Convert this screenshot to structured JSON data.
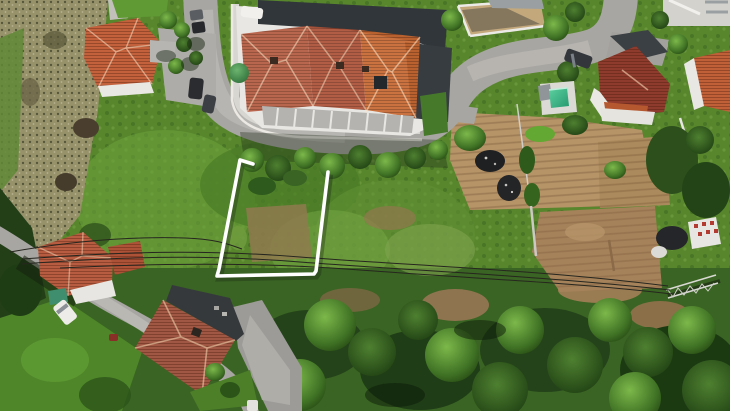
{
  "scene": {
    "type": "aerial-drone-photograph",
    "description": "Aerial drone view of a hillside building plot marked with a white boundary outline, surrounded by houses with terracotta tile roofs, curving asphalt streets, vegetable gardens, scrubland, power lines with a lattice pylon, and dense trees",
    "width_px": 730,
    "height_px": 411
  },
  "palette": {
    "field_green": "#57862d",
    "field_light": "#7db64a",
    "field_dark": "#2f5a1d",
    "forest_dark": "#24431a",
    "forest_base": "#3a6423",
    "scrub_khaki": "#97926a",
    "scrub_dark": "#4a4232",
    "road_gray": "#a8a6a2",
    "road_light": "#c2c0bb",
    "sidewalk": "#d8d6d1",
    "wall_white": "#ebe9e4",
    "roof_orange": "#c8672f",
    "roof_red": "#ab4f35",
    "roof_brown": "#b4593f",
    "roof_dark_red": "#8e3b2d",
    "roof_muted": "#a05844",
    "shadow_dark": "#2f3539",
    "dirt_tan": "#b69468",
    "dirt_brown": "#a5825a",
    "pool_green": "#36b488",
    "boundary_white": "#ffffff",
    "wire_dark": "#26261f"
  },
  "features": {
    "plot_boundary": {
      "label": "white plot boundary marking",
      "shape": "open-top rectangle",
      "color": "#ffffff"
    },
    "house_complex_center": {
      "label": "terraced houses with three terracotta hip roofs"
    },
    "house_top_left": {
      "label": "detached house with orange hip roof"
    },
    "house_right": {
      "label": "house with dark red roof"
    },
    "house_bottom_left_a": {
      "label": "house with orange tiled roof by the lane"
    },
    "house_bottom_left_b": {
      "label": "large house with muted red cross-hip roof"
    },
    "pool": {
      "label": "small green swimming pool"
    },
    "pylon": {
      "label": "steel lattice electricity pylon"
    },
    "power_lines": {
      "label": "overhead power lines crossing the plot"
    },
    "gardens": {
      "label": "tilled vegetable garden plots"
    },
    "vehicles": {
      "label": "parked cars and white vans"
    }
  }
}
